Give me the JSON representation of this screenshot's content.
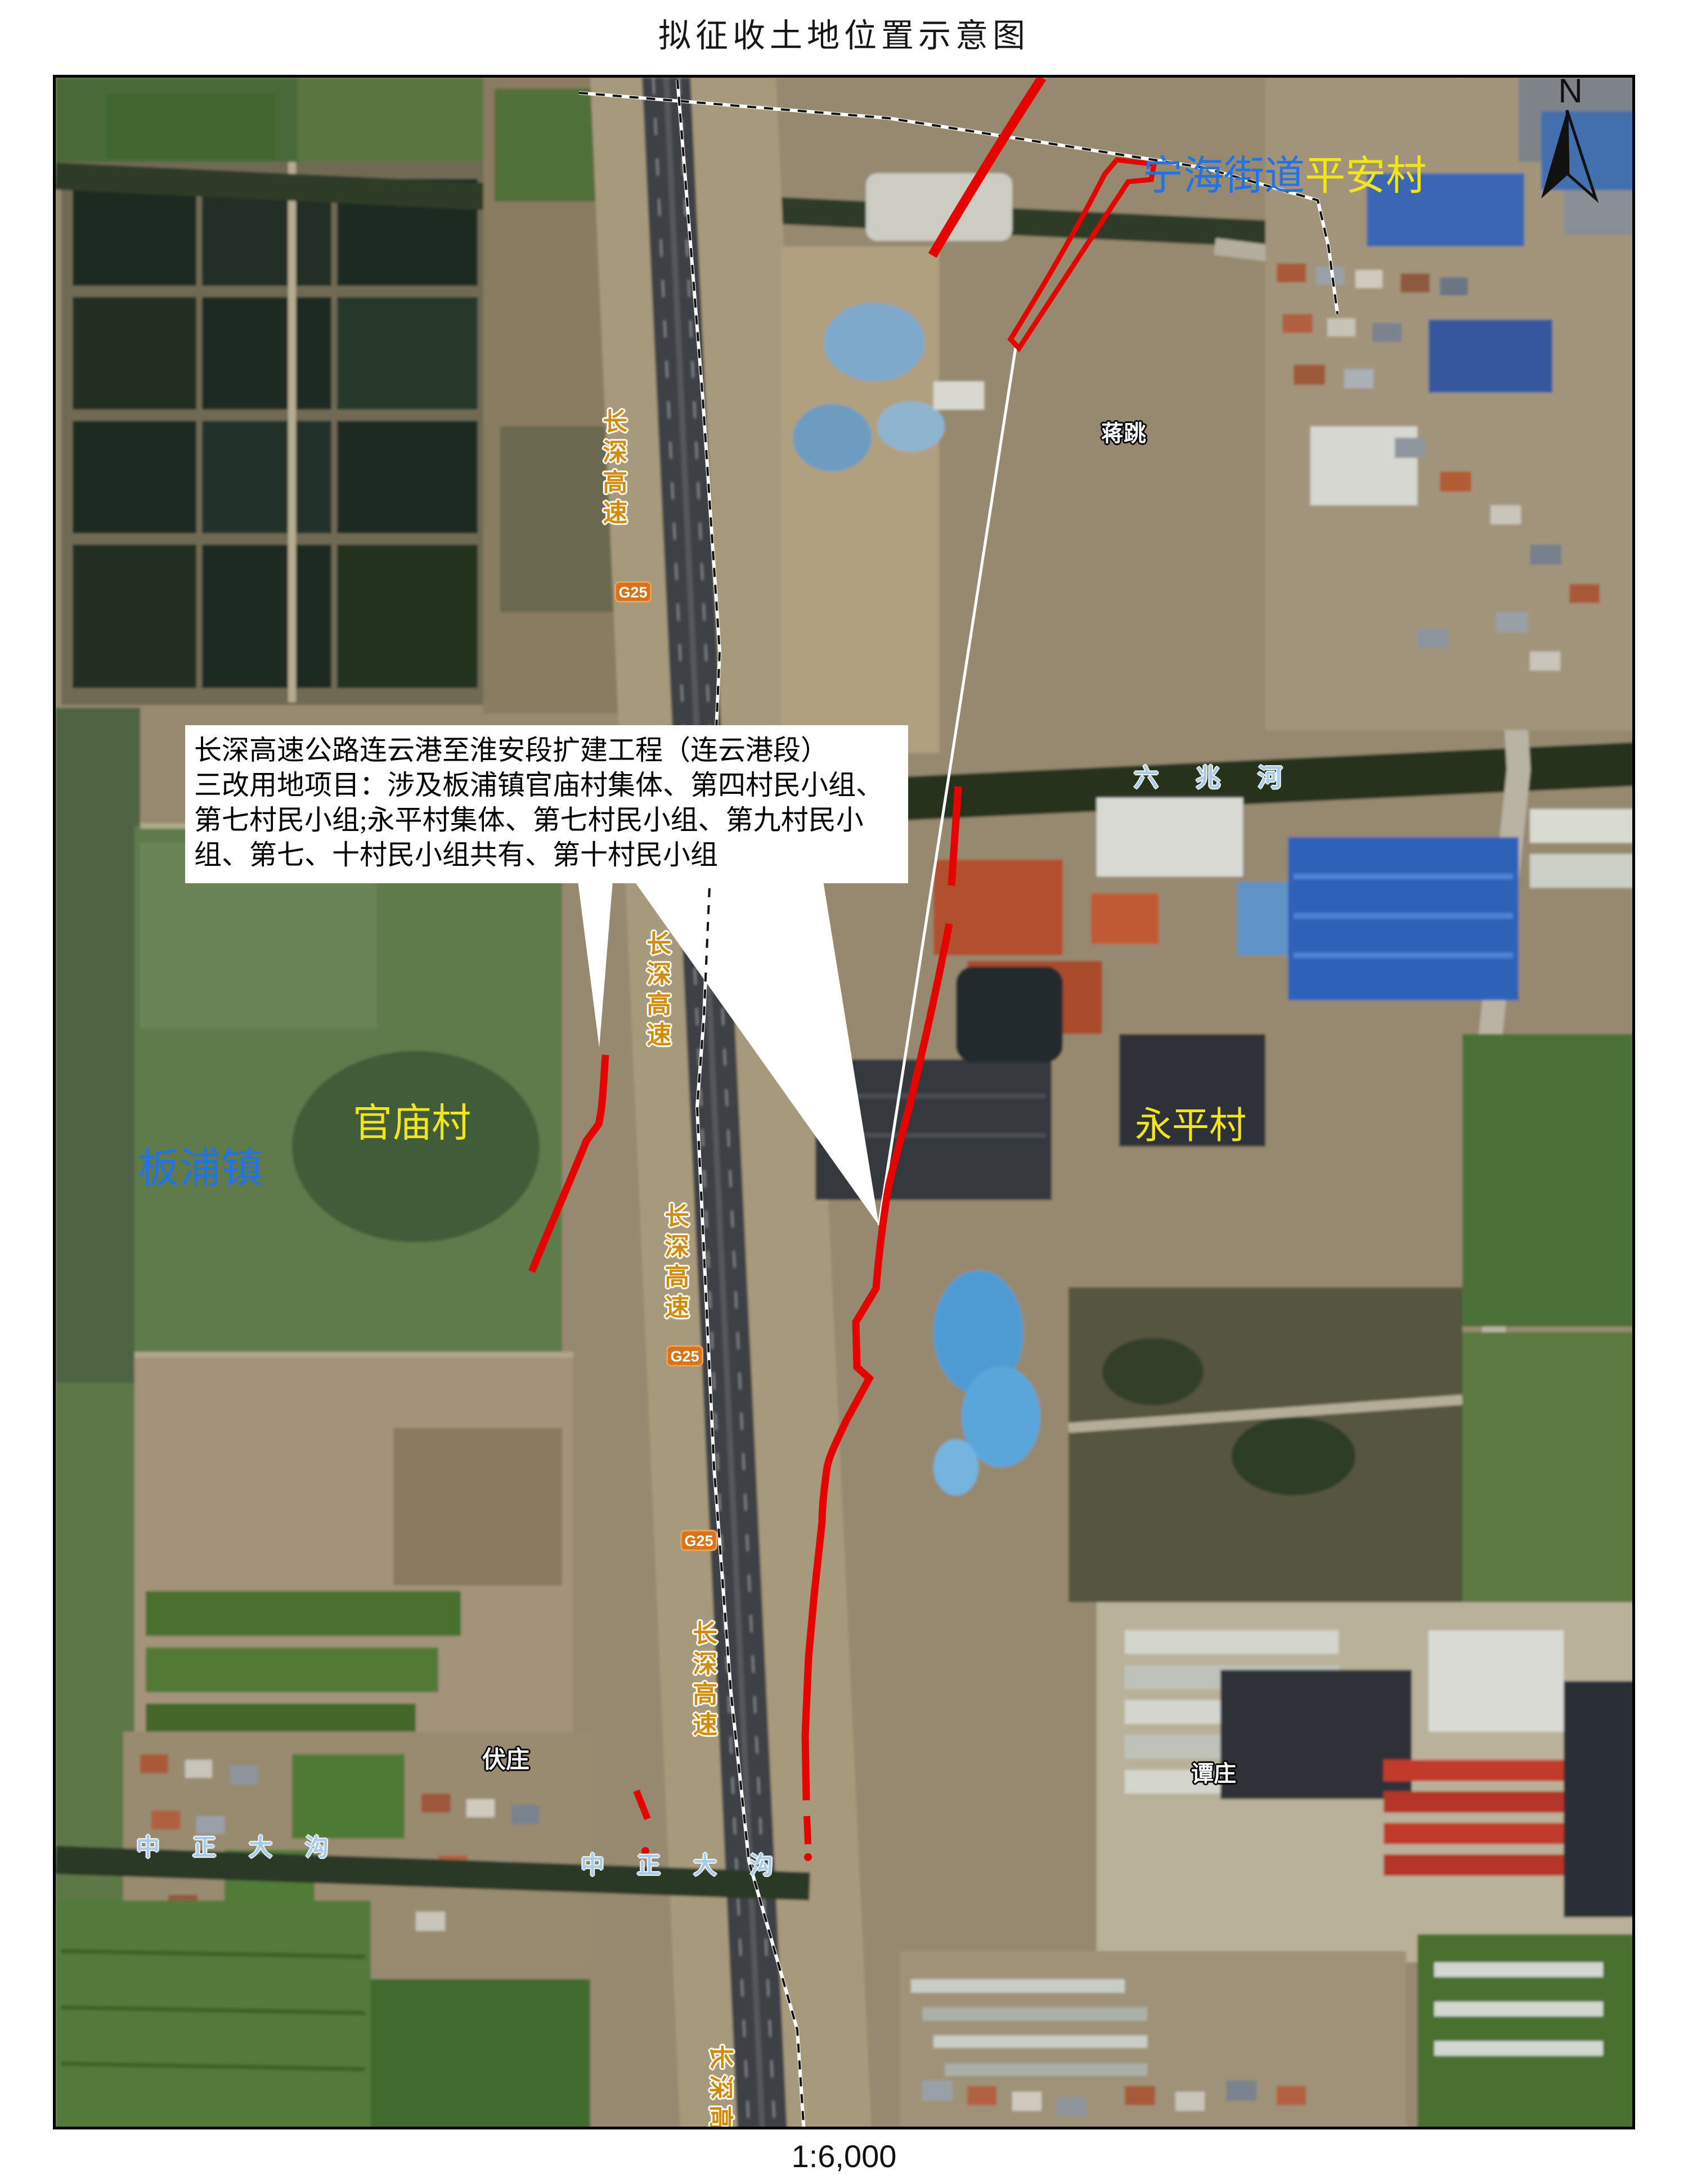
{
  "page": {
    "title": "拟征收土地位置示意图",
    "scale_text": "1:6,000",
    "north_label": "N"
  },
  "callout": {
    "line1": "长深高速公路连云港至淮安段扩建工程（连云港段）",
    "line2": "三改用地项目：涉及板浦镇官庙村集体、第四村民小组、",
    "line3": "第七村民小组;永平村集体、第七村民小组、第九村民小",
    "line4": "组、第七、十村民小组共有、第十村民小组"
  },
  "labels": {
    "town_banpu": "板浦镇",
    "street_ninghai": "宁海街道",
    "village_pingan": "平安村",
    "village_guanmiao": "官庙村",
    "village_yongping": "永平村",
    "hamlet_jiangtiao": "蒋跳",
    "hamlet_fuzhuang": "伏庄",
    "hamlet_tanzhuang": "谭庄",
    "river_liuzhao": "六兆河",
    "ditch_zhongzheng": "中正大沟",
    "highway_changshen": "长深高速",
    "shield_g25": "G25"
  },
  "colors": {
    "boundary_red": "#e60400",
    "town_label_blue": "#2273e8",
    "village_label_yellow": "#f2e51c",
    "water_label_blue": "#a7cce8",
    "road_label_gold": "#cf8c0e",
    "shield_orange": "#d9731a",
    "dashed_boundary_black": "#111111"
  }
}
